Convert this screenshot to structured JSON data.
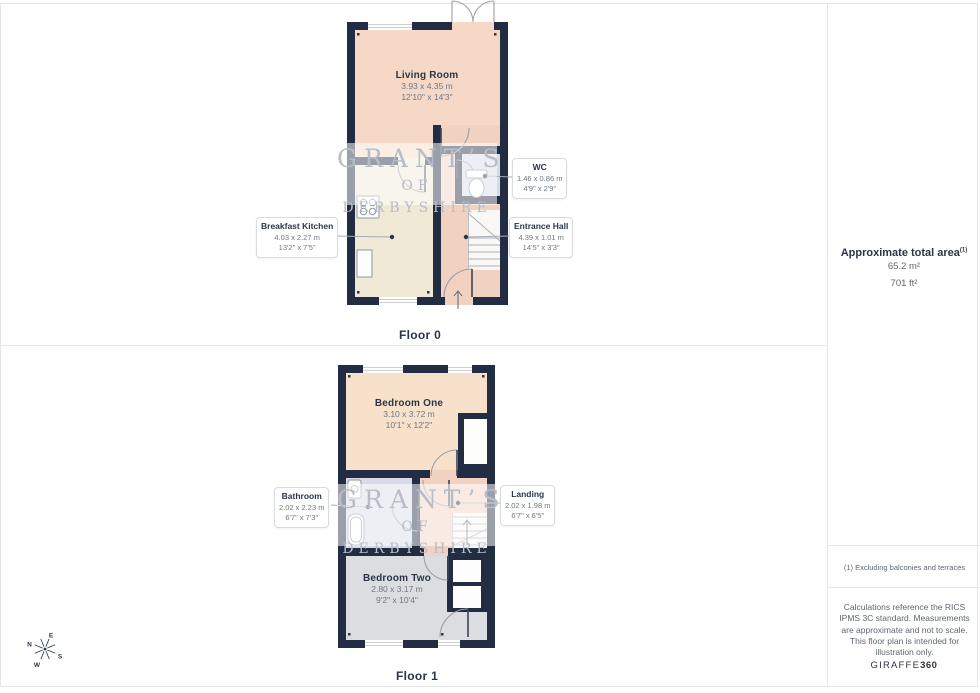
{
  "watermark": {
    "line1": "GRANT’S",
    "line2": "OF DERBYSHIRE"
  },
  "floor0": {
    "title": "Floor 0",
    "living_room": {
      "name": "Living Room",
      "metric": "3.93 x 4.35 m",
      "imperial": "12'10\" x 14'3\""
    },
    "wc": {
      "name": "WC",
      "metric": "1.46 x 0.86 m",
      "imperial": "4'9\" x 2'9\""
    },
    "breakfast_kitchen": {
      "name": "Breakfast Kitchen",
      "metric": "4.03 x 2.27 m",
      "imperial": "13'2\" x 7'5\""
    },
    "entrance_hall": {
      "name": "Entrance Hall",
      "metric": "4.39 x 1.01 m",
      "imperial": "14'5\" x 3'3\""
    }
  },
  "floor1": {
    "title": "Floor 1",
    "bedroom_one": {
      "name": "Bedroom One",
      "metric": "3.10 x 3.72 m",
      "imperial": "10'1\" x 12'2\""
    },
    "bathroom": {
      "name": "Bathroom",
      "metric": "2.02 x 2.23 m",
      "imperial": "6'7\" x 7'3\""
    },
    "landing": {
      "name": "Landing",
      "metric": "2.02 x 1.98 m",
      "imperial": "6'7\" x 6'5\""
    },
    "bedroom_two": {
      "name": "Bedroom Two",
      "metric": "2.80 x 3.17 m",
      "imperial": "9'2\" x 10'4\""
    }
  },
  "sidebar": {
    "area_title": "Approximate total area",
    "area_footnote_marker": "(1)",
    "area_m2": "65.2 m²",
    "area_ft2": "701 ft²",
    "footnote": "(1) Excluding balconies and terraces",
    "disclaimer": "Calculations reference the RICS IPMS 3C standard. Measurements are approximate and not to scale. This floor plan is intended for illustration only.",
    "brand_name": "GIRAFFE",
    "brand_suffix": "360"
  },
  "compass": {
    "north": "N",
    "east": "E",
    "south": "S",
    "west": "W"
  },
  "colors": {
    "wall": "#222c42",
    "living": "#f5d9c6",
    "hall": "#f1d2c0",
    "kitchen": "#efe9d6",
    "wet_room": "#d7dbe8",
    "bedroom_one": "#f8e1cb",
    "bedroom_two": "#dcdde0",
    "label_title": "#2b3547",
    "label_dims": "#6e7787"
  }
}
